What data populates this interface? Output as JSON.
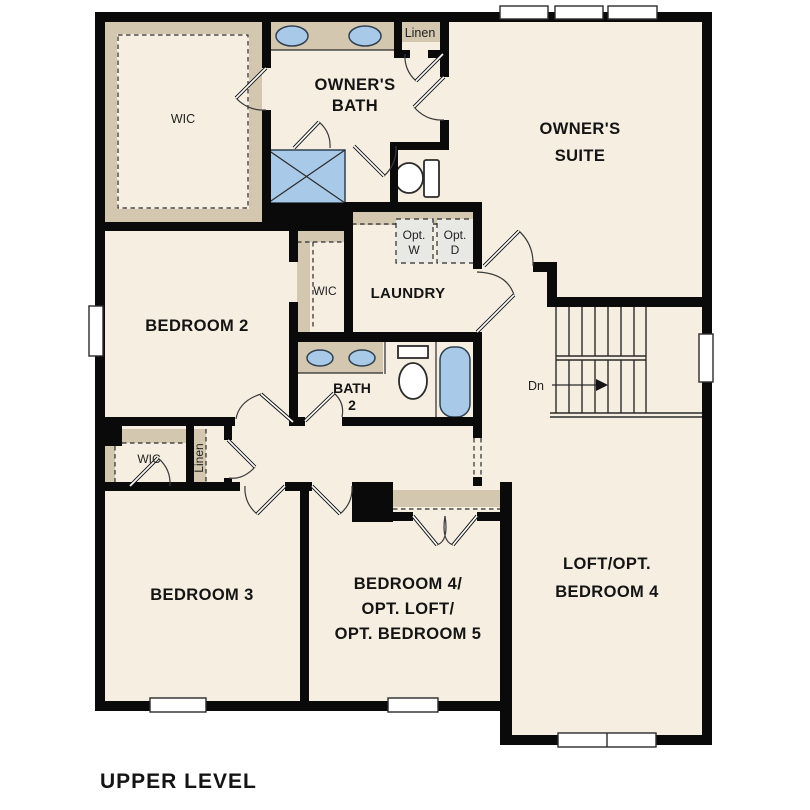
{
  "colors": {
    "floor": "#f5eee1",
    "wall": "#0a0a0a",
    "tan": "#d3c7af",
    "blue": "#a9c9e8",
    "optbox": "#e8e8e4",
    "text": "#141414"
  },
  "plan_title": "UPPER LEVEL",
  "labels": {
    "owners_wic": "WIC",
    "owners_bath_1": "OWNER'S",
    "owners_bath_2": "BATH",
    "linen_top": "Linen",
    "owners_suite_1": "OWNER'S",
    "owners_suite_2": "SUITE",
    "opt_w_1": "Opt.",
    "opt_w_2": "W",
    "opt_d_1": "Opt.",
    "opt_d_2": "D",
    "wic_mid": "WIC",
    "laundry": "LAUNDRY",
    "bedroom2": "BEDROOM 2",
    "bath2_1": "BATH",
    "bath2_2": "2",
    "dn": "Dn",
    "wic_small": "WIC",
    "linen_vert": "Linen",
    "bedroom3": "BEDROOM 3",
    "bedroom4_1": "BEDROOM 4/",
    "bedroom4_2": "OPT. LOFT/",
    "bedroom4_3": "OPT. BEDROOM 5",
    "loft_1": "LOFT/OPT.",
    "loft_2": "BEDROOM 4"
  }
}
